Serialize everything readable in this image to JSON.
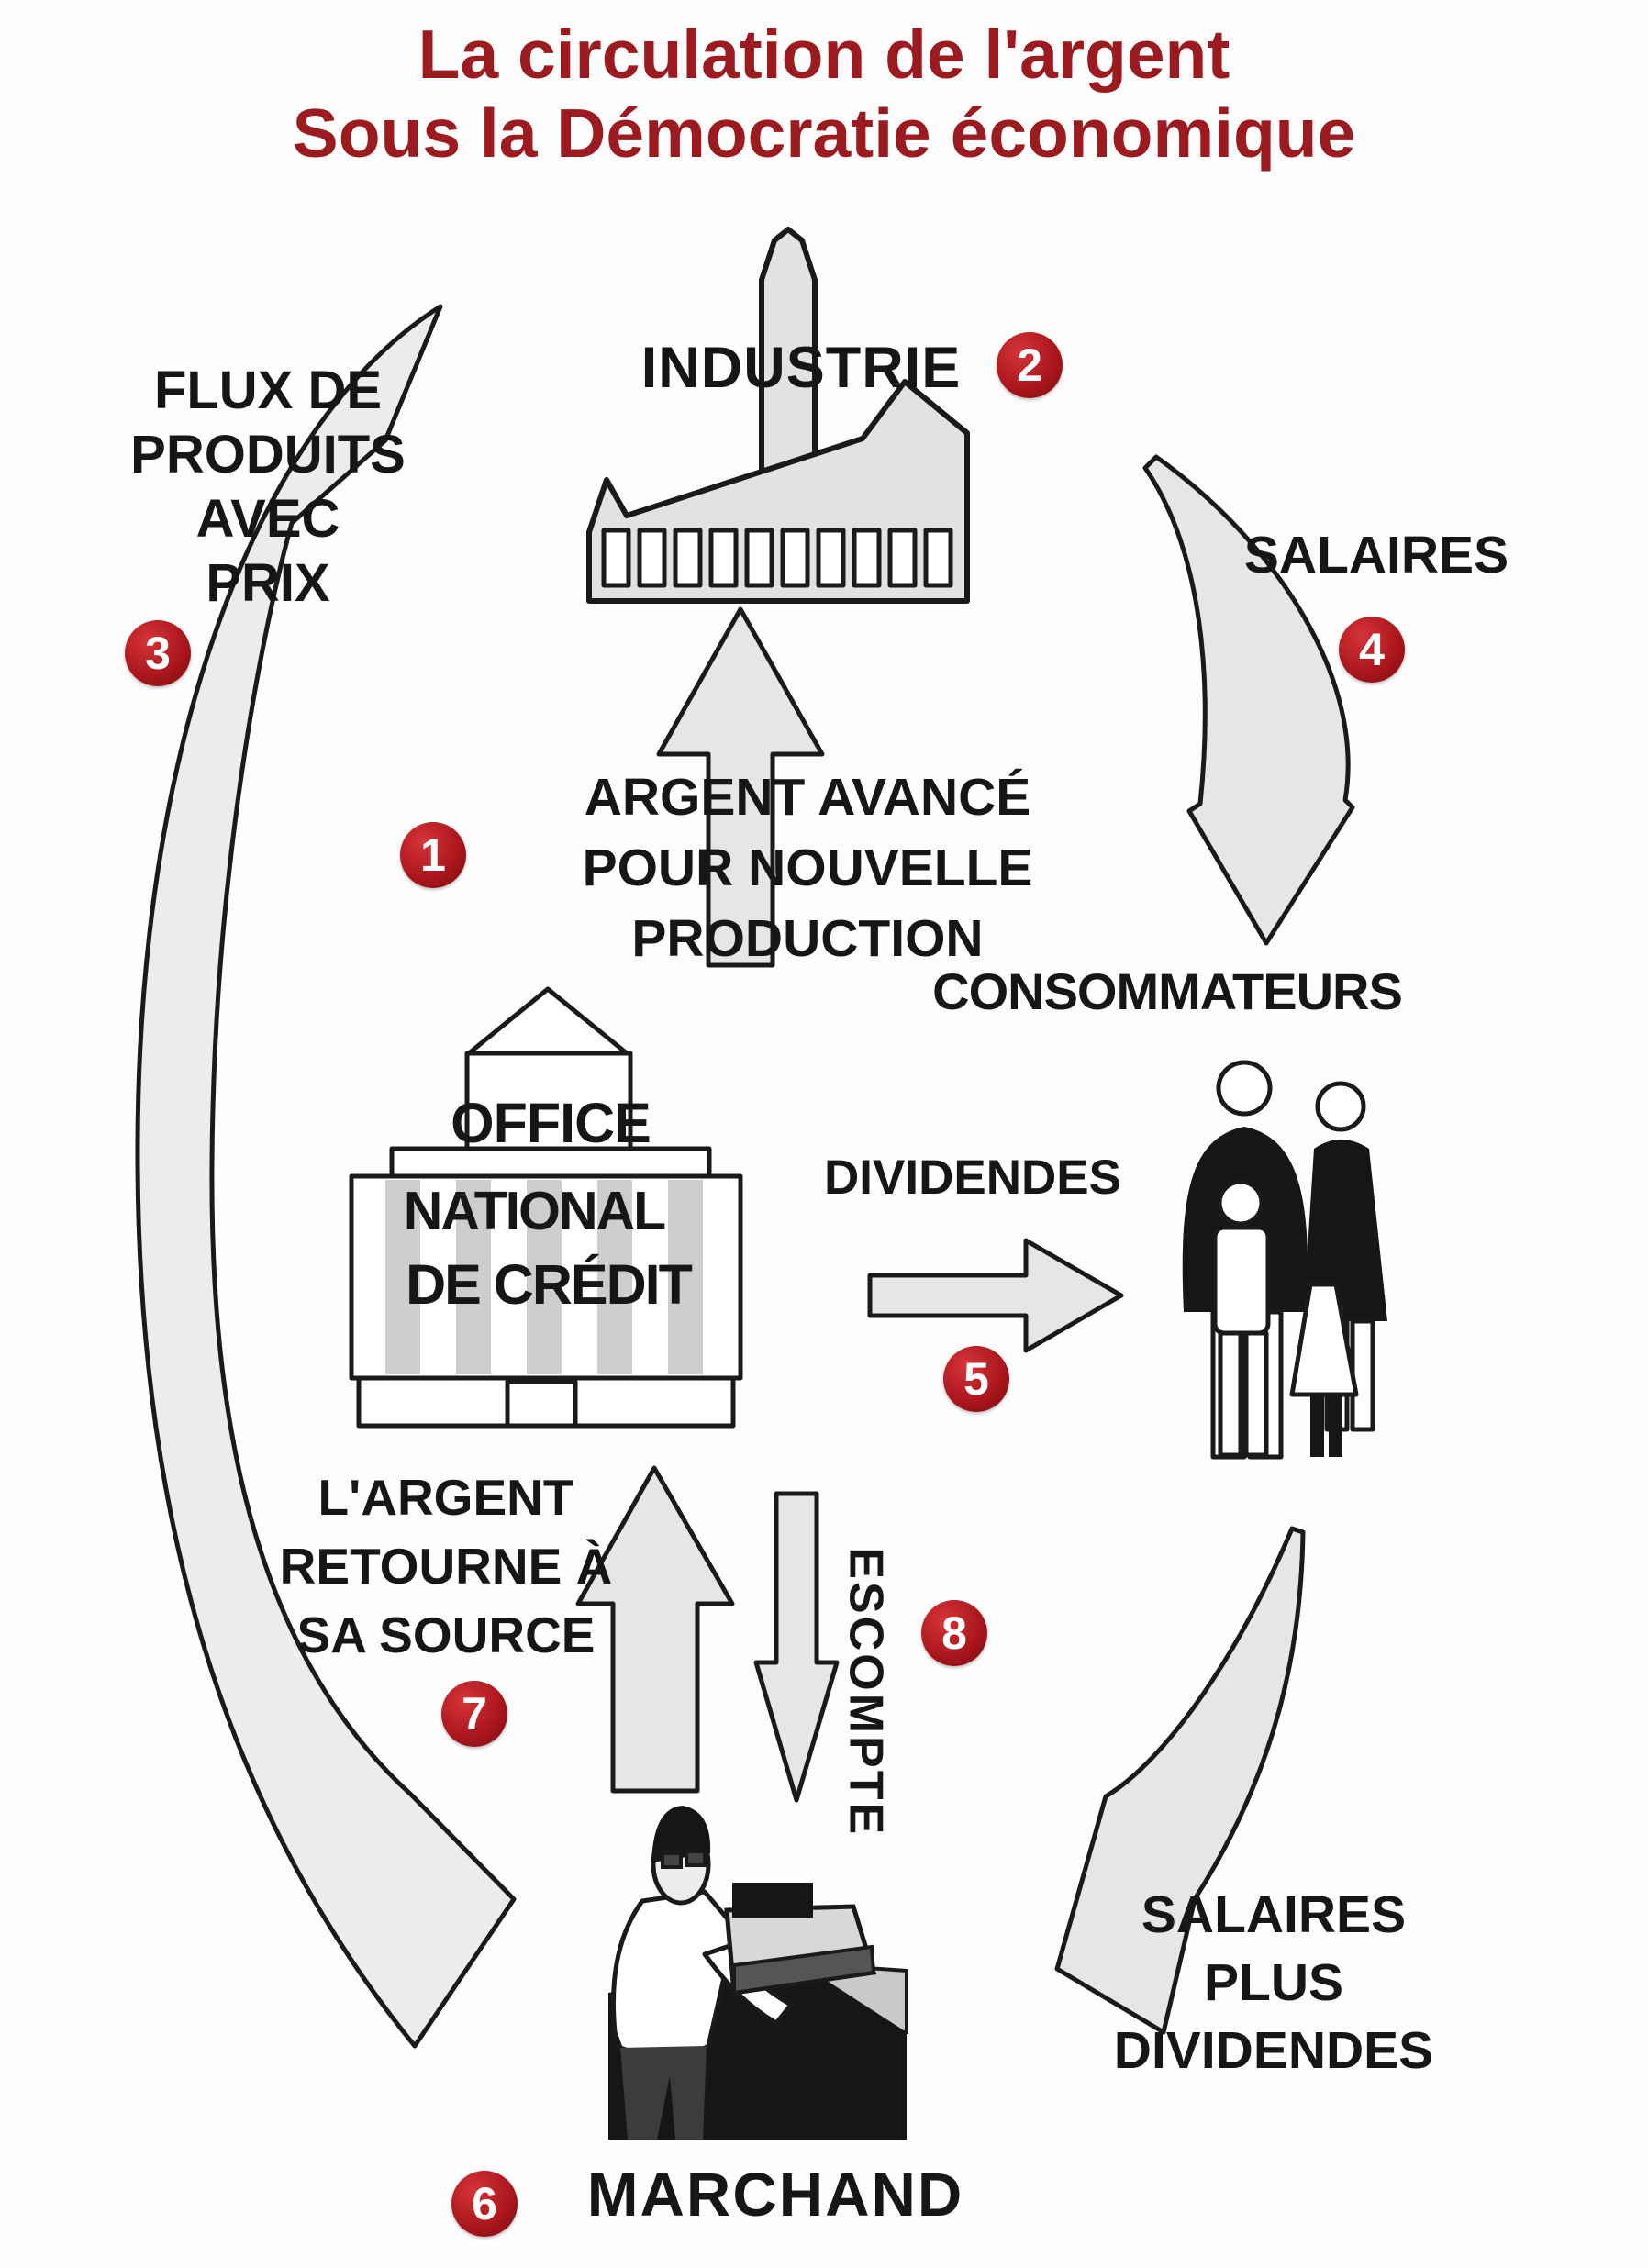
{
  "title": {
    "line1": "La circulation de l'argent",
    "line2": "Sous la Démocratie économique"
  },
  "nodes": {
    "industrie": {
      "label": "INDUSTRIE",
      "badge": "2"
    },
    "consommateurs": {
      "label": "CONSOMMATEURS"
    },
    "office_national_credit": {
      "line1": "OFFICE",
      "line2": "NATIONAL",
      "line3": "DE CRÉDIT"
    },
    "marchand": {
      "label": "MARCHAND",
      "badge": "6"
    }
  },
  "flows": {
    "argent_avance": {
      "badge": "1",
      "line1": "ARGENT AVANCÉ",
      "line2": "POUR NOUVELLE",
      "line3": "PRODUCTION"
    },
    "flux_produits": {
      "badge": "3",
      "line1": "FLUX DE",
      "line2": "PRODUITS",
      "line3": "AVEC",
      "line4": "PRIX"
    },
    "salaires": {
      "badge": "4",
      "label": "SALAIRES"
    },
    "dividendes": {
      "badge": "5",
      "label": "DIVIDENDES"
    },
    "retour_source": {
      "badge": "7",
      "line1": "L'ARGENT",
      "line2": "RETOURNE À",
      "line3": "SA SOURCE"
    },
    "escompte": {
      "badge": "8",
      "label": "ESCOMPTE"
    },
    "salaires_dividendes": {
      "line1": "SALAIRES",
      "line2": "PLUS",
      "line3": "DIVIDENDES"
    }
  },
  "colors": {
    "title": "#9b1b20",
    "badge": "#a8151b",
    "text": "#161616",
    "arrow_fill": "#e6e6e6",
    "outline": "#1a1a1a"
  }
}
